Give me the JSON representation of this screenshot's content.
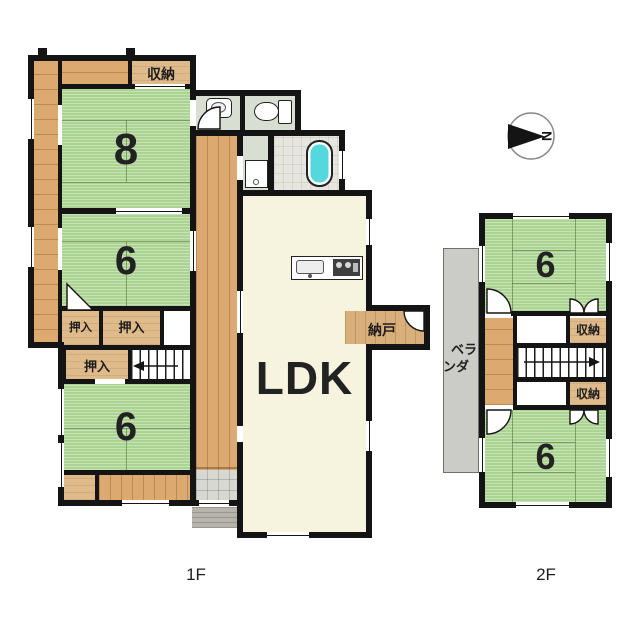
{
  "palette": {
    "wall": "#141414",
    "tatami_green": "#abd391",
    "wood_floor": "#dcaa70",
    "closet_tan": "#dfba8b",
    "ldk_floor": "#f6f3de",
    "bathtub_cyan": "#54d8dd",
    "sanitary_gray": "#d9ded2",
    "genkan_tile": "#d8d8d2",
    "porch_gray": "#b6b4ac",
    "veranda_gray": "#cbcbc8"
  },
  "floor1": {
    "label": "1F",
    "rooms": {
      "storage_top": "収納",
      "tatami8": "8",
      "tatami6_middle": "6",
      "tatami6_bottom": "6",
      "closet_a": "押入",
      "closet_b": "押入",
      "closet_c": "押入",
      "ldk": "LDK",
      "nando": "納戸"
    }
  },
  "floor2": {
    "label": "2F",
    "rooms": {
      "tatami6_north": "6",
      "tatami6_south": "6",
      "storage_upper": "収納",
      "storage_lower": "収納"
    },
    "veranda": {
      "line1": "ベラ",
      "line2": "ンダ"
    }
  },
  "compass": {
    "north_label": "N"
  }
}
